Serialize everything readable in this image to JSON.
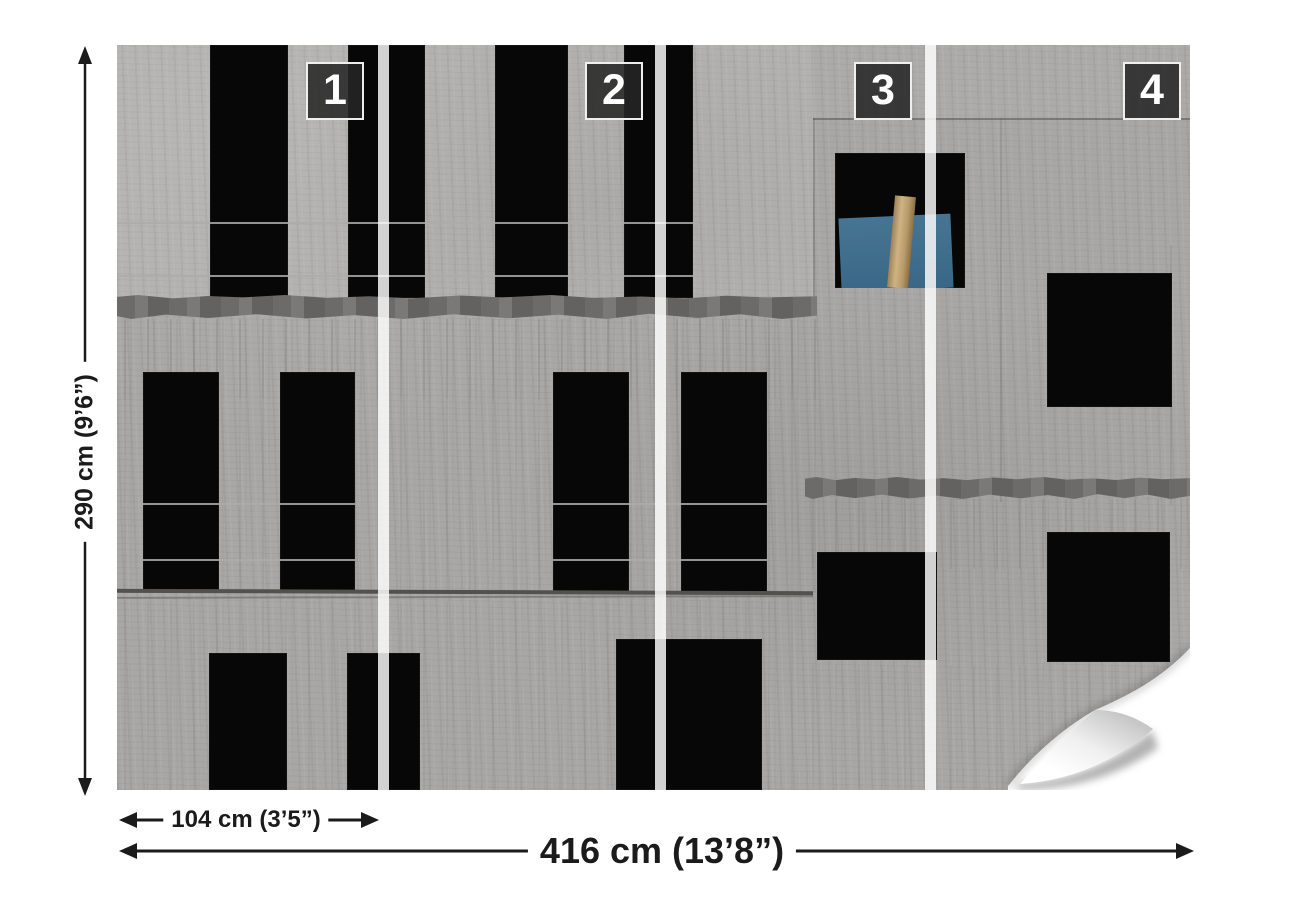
{
  "panel_labels": [
    "1",
    "2",
    "3",
    "4"
  ],
  "dimensions": {
    "height": "290 cm (9’6”)",
    "panel_width": "104 cm (3’5”)",
    "total_width": "416 cm (13’8”)"
  },
  "photo": {
    "alt": "concrete building facade under construction with black window openings, one window with blue panel and wooden plank",
    "colors": {
      "concrete": "#a8a7a5",
      "concrete_light": "#b4b3b1",
      "opening_black": "#070707",
      "mortar": "#6c6b69",
      "blue_panel": "#3e6c8d",
      "wood_plank": "#c4a677",
      "divider_stripe": "rgba(255,255,255,0.82)"
    }
  },
  "annotation": {
    "line_color": "#1b1b1b",
    "badge_background": "rgba(38,38,38,0.87)",
    "badge_border": "rgba(255,255,255,0.92)"
  }
}
